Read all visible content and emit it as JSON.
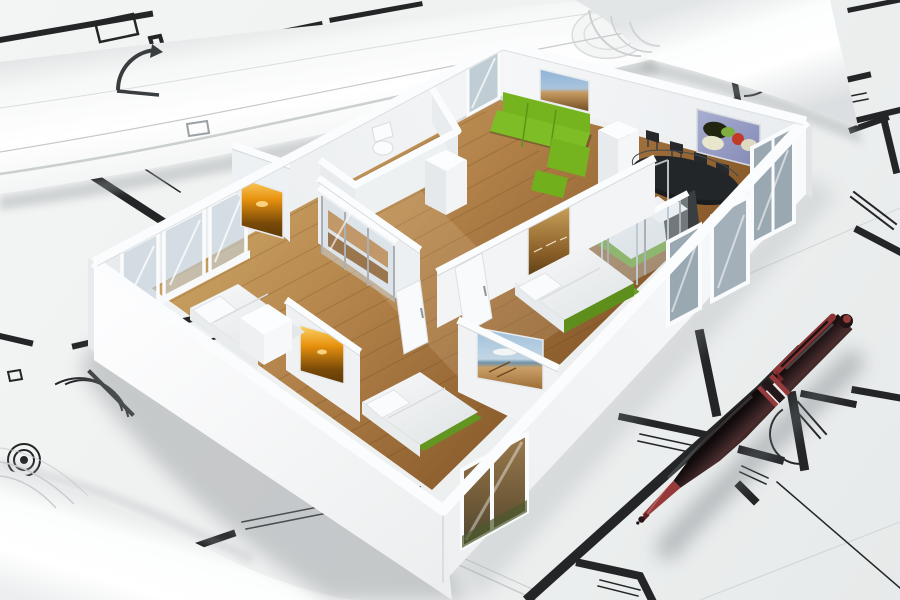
{
  "scene": {
    "title": "3D cutaway apartment floor-plan model standing on architectural blueprints with a dark red ballpoint pen",
    "description": "Photorealistic render: a white miniature apartment model with wooden floors, furniture and framed artworks sits on rolled and flat architect drawings; a maroon ballpoint pen lies diagonally on the plans at lower right.",
    "objects": {
      "model": {
        "label": "cutaway apartment model",
        "rooms": [
          "living room with green sofa and cityscape painting",
          "dining area with black table and four chairs",
          "glass-enclosed bedroom with metal-post bed",
          "center bedroom with platform bed",
          "lower bedroom with platform bed",
          "left bedroom with bed and white chest",
          "bathroom with toilet",
          "hallway with glass sliding wardrobe"
        ]
      },
      "artworks": [
        {
          "label": "cityscape painting",
          "wall": "back wall above green sofa"
        },
        {
          "label": "still-life painting with vegetables",
          "wall": "back wall of dining area"
        },
        {
          "label": "sunset painting",
          "wall": "left bedroom partition"
        },
        {
          "label": "sunset painting",
          "wall": "lower bedroom partition"
        },
        {
          "label": "sepia waterfront painting",
          "wall": "center bedroom wall"
        },
        {
          "label": "beach pier painting",
          "wall": "lower bedroom wall"
        }
      ],
      "furniture": [
        "green three-seat sofa with chaise and ottoman",
        "black dining table with four chairs",
        "bed with silver posts and dark headboard",
        "white platform bed with green base",
        "white platform bed with green base",
        "white bed with chest at foot",
        "glass sliding wardrobe with wooden shelves",
        "white toilet"
      ],
      "blueprints": {
        "label": "architectural blueprint sheets",
        "elements": [
          "thick black wall lines",
          "double-line window symbols",
          "door swing arcs",
          "target circle symbol",
          "rolled blueprint upper left",
          "rolled blueprint upper right",
          "rolled blueprint lower left"
        ]
      },
      "pen": {
        "label": "dark maroon ballpoint pen",
        "details": [
          "red clip with dark slot",
          "red trim rings",
          "red tapered tip",
          "red cap button"
        ]
      }
    },
    "palette": {
      "paper": "#eff1f1",
      "paper_bright": "#fafbfb",
      "paper_shadow": "#c9cdce",
      "plan_line": "#232527",
      "plan_line_faint": "#b8bdc0",
      "wall_white": "#fbfcfd",
      "wall_light": "#f2f4f6",
      "wall_mid": "#e7eaed",
      "wall_shade": "#d9dde0",
      "floor_light": "#cda565",
      "floor_mid": "#b08048",
      "floor_dark": "#8a5c2c",
      "sofa_green": "#76b41f",
      "sofa_green_dark": "#5d9413",
      "bed_green": "#6aa028",
      "table_black": "#232629",
      "glass_blue": "#aebfca",
      "art_sky": "#8fb3d6",
      "art_city": "#c79a60",
      "art_sunset": "#e8920f",
      "art_sunset_deep": "#7a4a08",
      "art_still_bg": "#a9aed2",
      "art_red": "#c13a28",
      "art_green": "#7fae3f",
      "pen_body": "#2e1d1f",
      "pen_red": "#96393a",
      "pen_dark": "#1c1214"
    }
  }
}
